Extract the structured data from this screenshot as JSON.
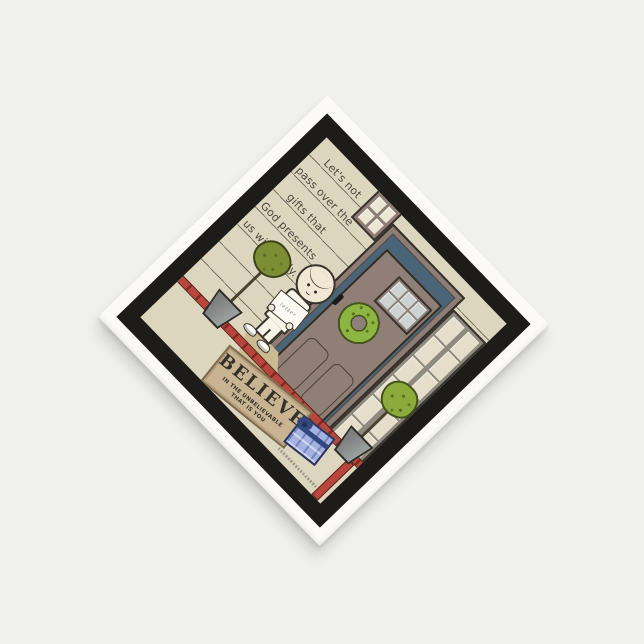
{
  "artwork": {
    "quote_lines": [
      "Let's not",
      "pass over the",
      "gifts that",
      "God presents",
      "us with daily."
    ],
    "doormat": {
      "title": "BELIEVE",
      "subtitle": [
        "IN THE UNBELIEVABLE",
        "THAT IS YOU"
      ]
    },
    "letter_label": "letter",
    "colors": {
      "page_background": "#f0f0ee",
      "napkin_white": "#fbfaf7",
      "border_black": "#1e1c19",
      "art_background": "#ddd6bf",
      "door_taupe": "#8f7f77",
      "doorway_blue": "#4a6577",
      "wreath_green": "#8cb542",
      "topiary_olive": "#7d8d33",
      "topiary_green": "#8dab3c",
      "rail_red": "#b8463c",
      "mat_tan": "#c8b392",
      "gift_blue": "#a3b2e0",
      "pane_cream": "#e4decb",
      "door_glass": "#cdd3d3"
    }
  }
}
